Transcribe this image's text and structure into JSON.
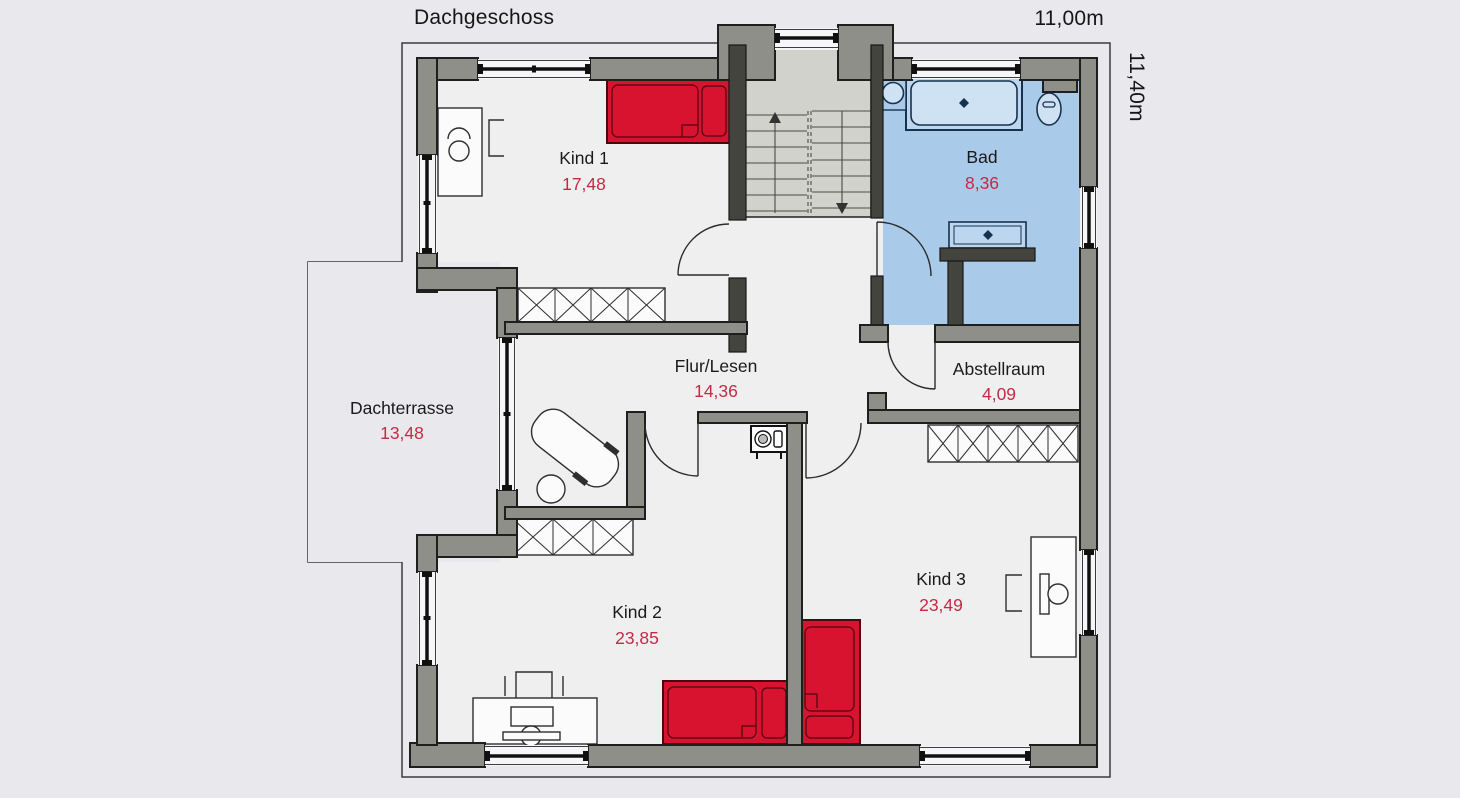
{
  "header": {
    "title": "Dachgeschoss"
  },
  "dimensions": {
    "width_label": "11,00m",
    "height_label": "11,40m"
  },
  "rooms": [
    {
      "id": "kind1",
      "name": "Kind 1",
      "area": "17,48"
    },
    {
      "id": "bad",
      "name": "Bad",
      "area": "8,36"
    },
    {
      "id": "flur",
      "name": "Flur/Lesen",
      "area": "14,36"
    },
    {
      "id": "abstellraum",
      "name": "Abstellraum",
      "area": "4,09"
    },
    {
      "id": "dachterrasse",
      "name": "Dachterrasse",
      "area": "13,48"
    },
    {
      "id": "kind2",
      "name": "Kind 2",
      "area": "23,85"
    },
    {
      "id": "kind3",
      "name": "Kind 3",
      "area": "23,49"
    }
  ],
  "icons": [
    "bed-icon",
    "desk-icon",
    "office-chair-icon",
    "chair-icon",
    "wardrobe-icon",
    "staircase-icon",
    "stair-up-arrow-icon",
    "stair-down-arrow-icon",
    "bathtub-icon",
    "toilet-icon",
    "washbasin-icon",
    "vanity-icon",
    "washing-machine-icon",
    "lounge-chair-icon",
    "side-table-icon",
    "door-swing-icon",
    "window-icon",
    "dormer-window-icon"
  ],
  "colors": {
    "background": "#e9e9ed",
    "floor": "#efeff0",
    "wall": "#8f8f89",
    "wall_dark": "#44443f",
    "bathroom_fill": "#a9cbe9",
    "stair_fill": "#d2d2cc",
    "furniture_red": "#d8132f",
    "area_text": "#c32b45",
    "label_text": "#1a1a1a"
  }
}
